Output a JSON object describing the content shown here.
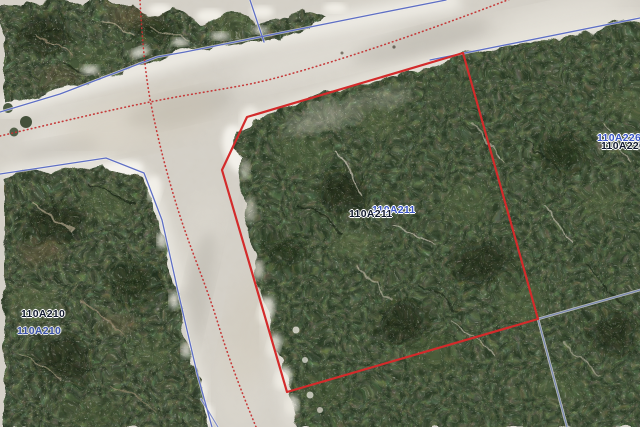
{
  "map": {
    "kind": "aerial-parcel-map",
    "labels": [
      {
        "name": "parcel-label-center-blue",
        "text": "110A211",
        "layer": "blue"
      },
      {
        "name": "parcel-label-center-black",
        "text": "110A211",
        "layer": "black"
      },
      {
        "name": "parcel-label-left-blue",
        "text": "110A210",
        "layer": "blue"
      },
      {
        "name": "parcel-label-left-black",
        "text": "110A210",
        "layer": "black"
      },
      {
        "name": "parcel-label-right-blue",
        "text": "110A226",
        "layer": "blue"
      },
      {
        "name": "parcel-label-right-black",
        "text": "110A226",
        "layer": "black"
      }
    ],
    "colors": {
      "selected_parcel_outline": "#d32b2b",
      "parcel_boundary_line": "#5f6fc4",
      "road_centerline_dotted": "#c43333",
      "label_black": "#111a2e",
      "label_blue": "#3a55c4",
      "road_surface": "#d3cfc6",
      "vegetation": "#2b3826"
    }
  }
}
